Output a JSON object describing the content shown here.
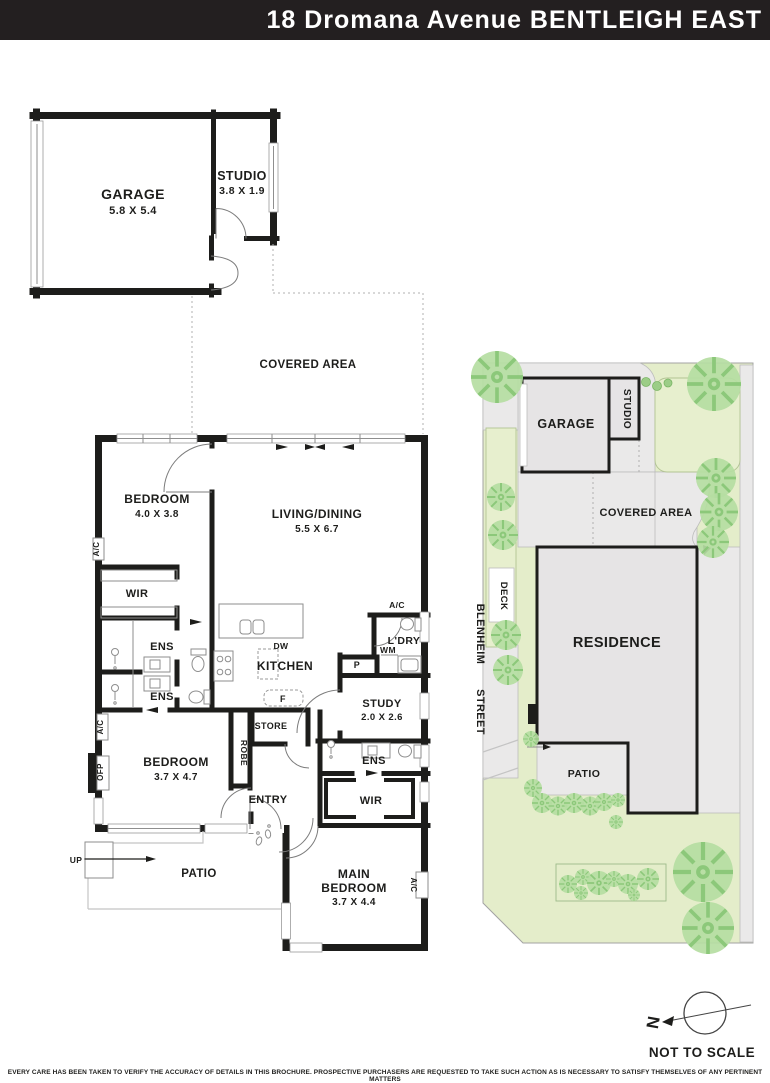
{
  "header": {
    "title": "18 Dromana Avenue BENTLEIGH EAST"
  },
  "floorplan": {
    "garage": {
      "label": "GARAGE",
      "dims": "5.8 X 5.4"
    },
    "studio": {
      "label": "STUDIO",
      "dims": "3.8 X 1.9"
    },
    "covered_area_label": "COVERED AREA",
    "bedroom1": {
      "label": "BEDROOM",
      "dims": "4.0 X 3.8"
    },
    "living_dining": {
      "label": "LIVING/DINING",
      "dims": "5.5 X 6.7"
    },
    "wir1_label": "WIR",
    "ens1_label": "ENS",
    "ens2_label": "ENS",
    "kitchen_label": "KITCHEN",
    "dishwasher_label": "DW",
    "fridge_label": "F",
    "store_label": "STORE",
    "robe_label": "ROBE",
    "pantry_label": "P",
    "washing_machine_label": "WM",
    "laundry_label": "L'DRY",
    "study": {
      "label": "STUDY",
      "dims": "2.0 X 2.6"
    },
    "ens3_label": "ENS",
    "bedroom2": {
      "label": "BEDROOM",
      "dims": "3.7 X 4.7"
    },
    "ofp_label": "OFP",
    "entry_label": "ENTRY",
    "wir2_label": "WIR",
    "up_label": "UP",
    "patio_label": "PATIO",
    "main_bedroom": {
      "label1": "MAIN",
      "label2": "BEDROOM",
      "dims": "3.7 X 4.4"
    },
    "ac_label": "A/C"
  },
  "siteplan": {
    "garage_label": "GARAGE",
    "studio_label": "STUDIO",
    "covered_area_label": "COVERED AREA",
    "residence_label": "RESIDENCE",
    "deck_label": "DECK",
    "patio_label": "PATIO",
    "street_name_line1": "BLENHEIM",
    "street_name_line2": "STREET"
  },
  "compass": {
    "north_label": "N",
    "scale_note": "NOT TO SCALE"
  },
  "footer": {
    "disclaimer": "EVERY CARE HAS BEEN TAKEN TO VERIFY THE ACCURACY OF DETAILS IN THIS BROCHURE. PROSPECTIVE PURCHASERS ARE REQUESTED TO TAKE SUCH ACTION AS IS NECESSARY TO SATISFY THEMSELVES OF ANY PERTINENT MATTERS"
  },
  "colors": {
    "header_bg": "#231f20",
    "wall": "#1d1d1b",
    "site_green": "#e4edca",
    "tree_green": "#b5dda2",
    "path_gray": "#eae9e9",
    "building_gray": "#e6e4e5"
  }
}
